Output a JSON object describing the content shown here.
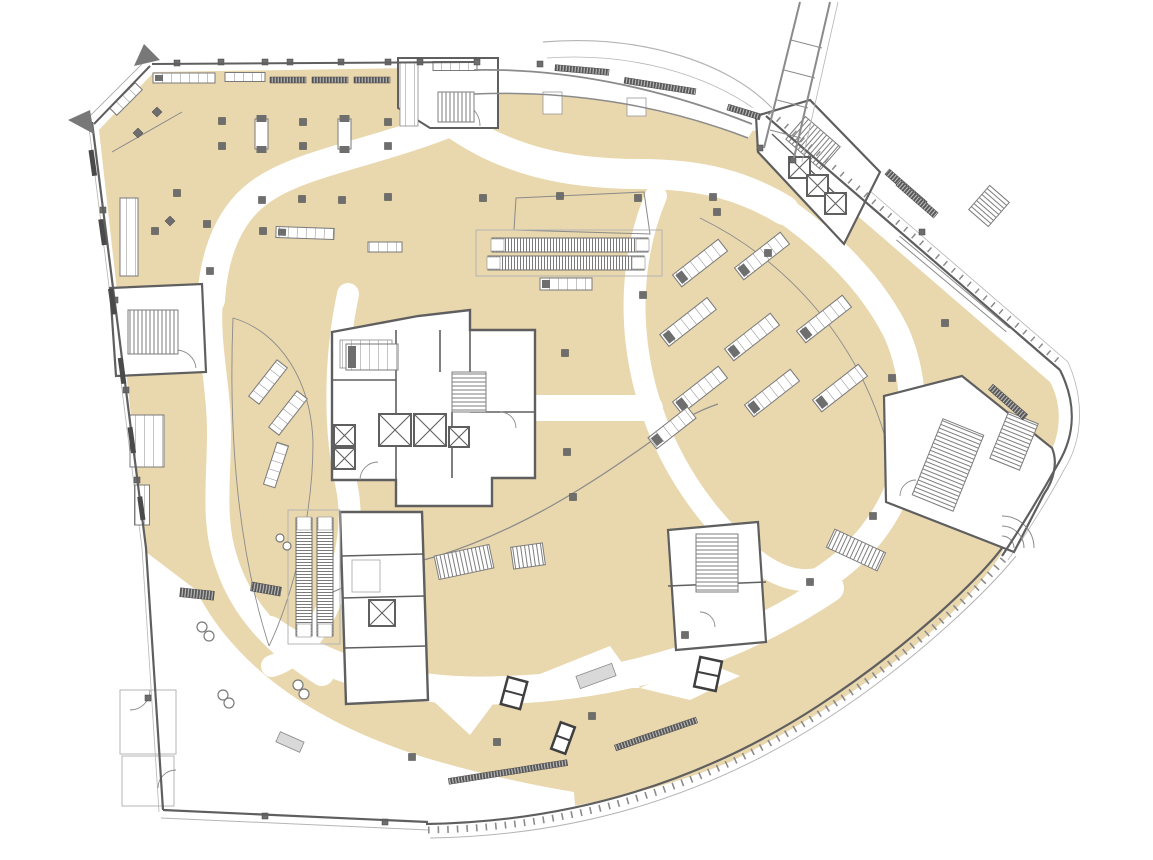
{
  "meta": {
    "label": "Department store floor plan — level plan with sales floors, circulation aisles, cores and fixtures",
    "type": "architectural-floor-plan"
  },
  "colors": {
    "background": "#ffffff",
    "floor": "#e9d7ad",
    "wall": "#5f5f5f",
    "dark": "#474747",
    "mid": "#8b8b8b",
    "light": "#b5b5b5",
    "column": "#6e6e6e",
    "fixture_line": "#7a7a7a",
    "slab": "#d9d9d9"
  },
  "legend": {
    "floor_area": "sales-floor",
    "white_paths": "circulation-aisle",
    "hatched_bands": "stairs-and-escalators",
    "x_boxes": "elevators",
    "small_dark_squares": "structural-columns",
    "compartment_rects": "merchandise-fixtures",
    "bottom_left_white": "back-of-house",
    "top_right_diagonal": "exterior-bridge"
  },
  "elements": {
    "columns": [
      [
        222,
        121
      ],
      [
        303,
        122
      ],
      [
        388,
        122
      ],
      [
        222,
        146
      ],
      [
        303,
        146
      ],
      [
        388,
        146
      ],
      [
        177,
        193
      ],
      [
        262,
        200
      ],
      [
        302,
        199
      ],
      [
        342,
        200
      ],
      [
        388,
        197
      ],
      [
        483,
        198
      ],
      [
        560,
        196
      ],
      [
        638,
        198
      ],
      [
        713,
        197
      ],
      [
        207,
        224
      ],
      [
        155,
        231
      ],
      [
        263,
        231
      ],
      [
        210,
        271
      ],
      [
        565,
        353
      ],
      [
        567,
        452
      ],
      [
        573,
        497
      ],
      [
        643,
        295
      ],
      [
        717,
        212
      ],
      [
        892,
        378
      ],
      [
        945,
        323
      ],
      [
        768,
        253
      ],
      [
        412,
        757
      ],
      [
        497,
        742
      ],
      [
        592,
        716
      ],
      [
        810,
        582
      ],
      [
        873,
        516
      ],
      [
        685,
        635
      ]
    ],
    "wall_squares": [
      [
        177,
        63
      ],
      [
        221,
        62
      ],
      [
        265,
        62
      ],
      [
        290,
        62
      ],
      [
        341,
        62
      ],
      [
        388,
        62
      ],
      [
        420,
        62
      ],
      [
        477,
        62
      ],
      [
        540,
        64
      ],
      [
        103,
        210
      ],
      [
        115,
        300
      ],
      [
        126,
        390
      ],
      [
        137,
        480
      ],
      [
        148,
        698
      ],
      [
        265,
        816
      ],
      [
        385,
        822
      ],
      [
        922,
        232
      ],
      [
        760,
        148
      ],
      [
        793,
        160
      ]
    ],
    "diamonds": [
      [
        157,
        112
      ],
      [
        138,
        133
      ],
      [
        170,
        221
      ]
    ],
    "slots": [
      [
        255,
        119
      ],
      [
        338,
        119
      ]
    ],
    "gondolas": [
      [
        700,
        263,
        58,
        15,
        -38
      ],
      [
        762,
        256,
        58,
        15,
        -38
      ],
      [
        688,
        322,
        60,
        15,
        -38
      ],
      [
        752,
        337,
        58,
        15,
        -38
      ],
      [
        824,
        319,
        58,
        15,
        -38
      ],
      [
        700,
        390,
        58,
        15,
        -38
      ],
      [
        772,
        393,
        58,
        15,
        -38
      ],
      [
        840,
        388,
        58,
        15,
        -38
      ],
      [
        672,
        428,
        50,
        14,
        -38
      ],
      [
        268,
        382,
        46,
        13,
        -52
      ],
      [
        288,
        413,
        46,
        13,
        -52
      ],
      [
        276,
        465,
        44,
        12,
        -72
      ],
      [
        305,
        233,
        58,
        11,
        2
      ],
      [
        385,
        247,
        34,
        10,
        0
      ],
      [
        566,
        284,
        52,
        12,
        0
      ],
      [
        184,
        78,
        62,
        10,
        0
      ],
      [
        245,
        77,
        40,
        9,
        0
      ],
      [
        455,
        66,
        44,
        9,
        0
      ],
      [
        129,
        237,
        18,
        78,
        0
      ],
      [
        147,
        441,
        34,
        52,
        0
      ],
      [
        142,
        505,
        15,
        40,
        0
      ],
      [
        126,
        99,
        36,
        10,
        -45
      ],
      [
        372,
        357,
        52,
        26,
        0
      ]
    ],
    "light_slabs": [
      [
        596,
        676,
        38,
        13,
        -20
      ],
      [
        290,
        742,
        26,
        11,
        24
      ]
    ],
    "rails": [
      [
        898,
        238,
        1008,
        330
      ]
    ],
    "louvers": [
      [
        582,
        70,
        54,
        6,
        5
      ],
      [
        660,
        86,
        72,
        6,
        9
      ],
      [
        744,
        112,
        34,
        6,
        17
      ],
      [
        906,
        188,
        50,
        7,
        41
      ],
      [
        917,
        199,
        50,
        7,
        41
      ],
      [
        197,
        594,
        34,
        9,
        6
      ],
      [
        266,
        589,
        30,
        9,
        10
      ],
      [
        288,
        80,
        36,
        6,
        0
      ],
      [
        330,
        80,
        36,
        6,
        0
      ],
      [
        372,
        80,
        36,
        6,
        0
      ],
      [
        508,
        772,
        120,
        6,
        -9
      ],
      [
        656,
        734,
        86,
        6,
        -19
      ],
      [
        1008,
        402,
        46,
        7,
        41
      ]
    ],
    "double_boxes": [
      [
        708,
        674,
        22,
        30,
        12
      ],
      [
        514,
        693,
        20,
        28,
        15
      ],
      [
        563,
        738,
        15,
        28,
        20
      ]
    ],
    "circles": [
      [
        202,
        627,
        5
      ],
      [
        209,
        636,
        5
      ],
      [
        223,
        695,
        5
      ],
      [
        229,
        703,
        5
      ],
      [
        298,
        685,
        5
      ],
      [
        304,
        694,
        5
      ],
      [
        280,
        538,
        4
      ],
      [
        287,
        546,
        4
      ]
    ],
    "elevators": [
      [
        379,
        414,
        32
      ],
      [
        414,
        414,
        32
      ],
      [
        449,
        427,
        20
      ],
      [
        334,
        425,
        21
      ],
      [
        334,
        448,
        21
      ],
      [
        789,
        157,
        21
      ],
      [
        807,
        175,
        21
      ],
      [
        825,
        193,
        21
      ],
      [
        369,
        600,
        26
      ]
    ],
    "stairs": [
      [
        438,
        92,
        36,
        30,
        0,
        "H"
      ],
      [
        128,
        310,
        50,
        44,
        0,
        "H"
      ],
      [
        452,
        372,
        34,
        40,
        0,
        "V"
      ],
      [
        790,
        128,
        46,
        30,
        41,
        "H"
      ],
      [
        926,
        424,
        44,
        82,
        22,
        "V"
      ],
      [
        998,
        416,
        32,
        50,
        22,
        "V"
      ],
      [
        696,
        534,
        42,
        58,
        0,
        "V"
      ],
      [
        436,
        550,
        56,
        24,
        -12,
        "H"
      ],
      [
        512,
        545,
        32,
        22,
        -8,
        "H"
      ],
      [
        828,
        540,
        56,
        20,
        25,
        "H"
      ],
      [
        976,
        190,
        26,
        32,
        41,
        "V"
      ]
    ],
    "escalators": [
      [
        492,
        238,
        156,
        14,
        0,
        "H"
      ],
      [
        488,
        256,
        156,
        14,
        0,
        "H"
      ],
      [
        296,
        518,
        16,
        118,
        0,
        "V"
      ],
      [
        317,
        518,
        16,
        118,
        0,
        "V"
      ]
    ]
  }
}
